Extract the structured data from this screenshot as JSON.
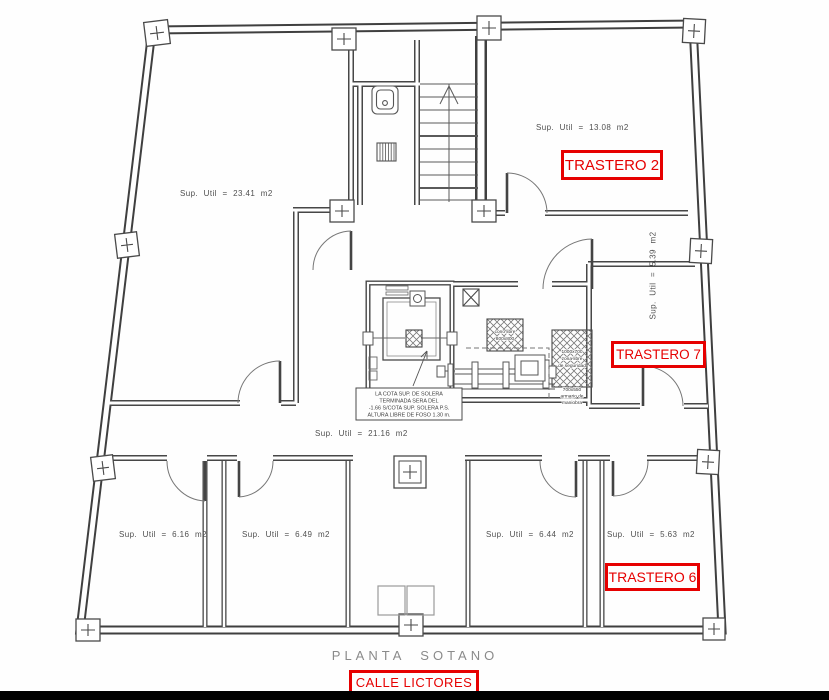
{
  "plan": {
    "title": "PLANTA SOTANO",
    "street": "CALLE LICTORES",
    "rooms": {
      "storage_large": {
        "area": "Sup. Util = 23.41 m2"
      },
      "trastero_2": {
        "area": "Sup. Util = 13.08 m2",
        "name": "TRASTERO 2"
      },
      "trastero_7": {
        "area": "Sup. Util = 5.39 m2",
        "name": "TRASTERO 7"
      },
      "hall": {
        "area": "Sup. Util = 21.16 m2"
      },
      "room_a": {
        "area": "Sup. Util = 6.16 m2"
      },
      "room_b": {
        "area": "Sup. Util = 6.49 m2"
      },
      "room_c": {
        "area": "Sup. Util = 6.44 m2"
      },
      "trastero_6": {
        "area": "Sup. Util = 5.63 m2",
        "name": "TRASTERO 6"
      }
    },
    "notes": {
      "pit": [
        "LA COTA SUP. DE SOLERA",
        "TERMINADA SERA DEL",
        "-1.66 S/COTA SUP. SOLERA P.S.",
        "ALTURA LIBRE DE FOSO 1.30 m."
      ],
      "free_cone": [
        "cono libre",
        "800x800"
      ],
      "safety_clear": [
        "1000x700",
        "zona libre",
        "de seguridad"
      ],
      "control_cabinet": [
        "700x550",
        "armario de",
        "maniobra"
      ]
    },
    "colors": {
      "highlight": "#e60000",
      "line": "#3f3f3f",
      "title_text": "#8a8a8a"
    }
  }
}
